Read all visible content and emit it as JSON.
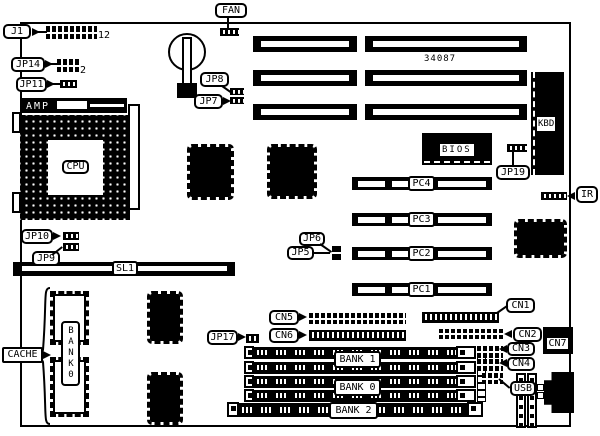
{
  "board": {
    "part_number": "34087",
    "callouts": {
      "j1": "J1",
      "fan": "FAN",
      "jp14": "JP14",
      "jp11": "JP11",
      "amp": "AMP",
      "cpu": "CPU",
      "jp8": "JP8",
      "jp7": "JP7",
      "kbd": "KBD",
      "bios": "BIOS",
      "jp19": "JP19",
      "ir": "IR",
      "jp10": "JP10",
      "jp9": "JP9",
      "sl1": "SL1",
      "jp6": "JP6",
      "jp5": "JP5",
      "pc4": "PC4",
      "pc3": "PC3",
      "pc2": "PC2",
      "pc1": "PC1",
      "cache": "CACHE",
      "cache_bank_vertical": "BANK0",
      "jp17": "JP17",
      "cn5": "CN5",
      "cn6": "CN6",
      "cn1": "CN1",
      "cn2": "CN2",
      "cn3": "CN3",
      "cn4": "CN4",
      "cn7": "CN7",
      "usb": "USB",
      "bank1": "BANK 1",
      "bank0": "BANK 0",
      "bank2": "BANK 2"
    },
    "pin_annotations": {
      "j1": "12",
      "jp14": "2"
    }
  }
}
